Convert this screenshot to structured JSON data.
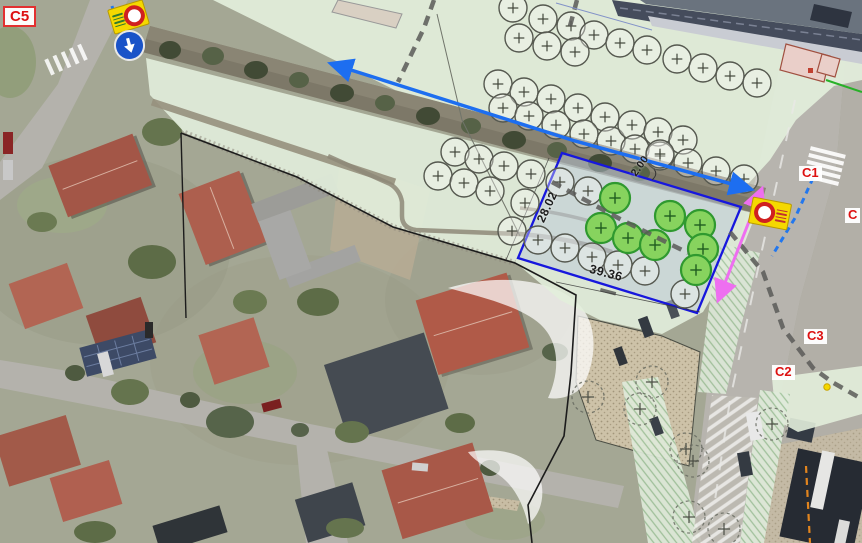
{
  "labels": {
    "c5": "C5",
    "c1": "C1",
    "c2": "C2",
    "c3": "C3",
    "edge": "C"
  },
  "dimensions": {
    "length": "39.36",
    "side": "28.02",
    "offset": "2.00"
  },
  "colors": {
    "plan_green": "#e2eedc",
    "boundary_blue": "#1717dd",
    "route_blue": "#1d6ef0",
    "route_pink": "#ee6ff0",
    "proposed_tree_green": "#87d35e",
    "sign_yellow": "#f5d800",
    "label_red": "#dd1111"
  },
  "trees": {
    "existing": [
      [
        513,
        8
      ],
      [
        543,
        19
      ],
      [
        571,
        26
      ],
      [
        594,
        35
      ],
      [
        620,
        43
      ],
      [
        647,
        50
      ],
      [
        677,
        59
      ],
      [
        703,
        68
      ],
      [
        730,
        76
      ],
      [
        757,
        83
      ],
      [
        519,
        38
      ],
      [
        547,
        46
      ],
      [
        575,
        52
      ],
      [
        498,
        84
      ],
      [
        524,
        92
      ],
      [
        551,
        99
      ],
      [
        578,
        108
      ],
      [
        605,
        117
      ],
      [
        503,
        108
      ],
      [
        529,
        116
      ],
      [
        556,
        125
      ],
      [
        584,
        134
      ],
      [
        611,
        141
      ],
      [
        632,
        125
      ],
      [
        658,
        132
      ],
      [
        683,
        140
      ],
      [
        635,
        149
      ],
      [
        660,
        156
      ],
      [
        455,
        152
      ],
      [
        479,
        159
      ],
      [
        504,
        166
      ],
      [
        531,
        174
      ],
      [
        438,
        176
      ],
      [
        464,
        183
      ],
      [
        490,
        191
      ],
      [
        525,
        203
      ],
      [
        560,
        182
      ],
      [
        588,
        191
      ],
      [
        660,
        154
      ],
      [
        688,
        163
      ],
      [
        716,
        171
      ],
      [
        744,
        179
      ],
      [
        512,
        231
      ],
      [
        538,
        240
      ],
      [
        565,
        248
      ],
      [
        592,
        257
      ],
      [
        618,
        265
      ],
      [
        645,
        271
      ],
      [
        685,
        294
      ]
    ],
    "proposed": [
      [
        615,
        198
      ],
      [
        670,
        216
      ],
      [
        601,
        228
      ],
      [
        628,
        238
      ],
      [
        700,
        225
      ],
      [
        655,
        245
      ],
      [
        703,
        249
      ],
      [
        696,
        270
      ]
    ],
    "faint": [
      [
        588,
        397
      ],
      [
        652,
        382
      ],
      [
        640,
        409
      ],
      [
        686,
        449
      ],
      [
        693,
        461
      ],
      [
        689,
        517
      ],
      [
        724,
        529
      ],
      [
        772,
        424
      ]
    ]
  }
}
